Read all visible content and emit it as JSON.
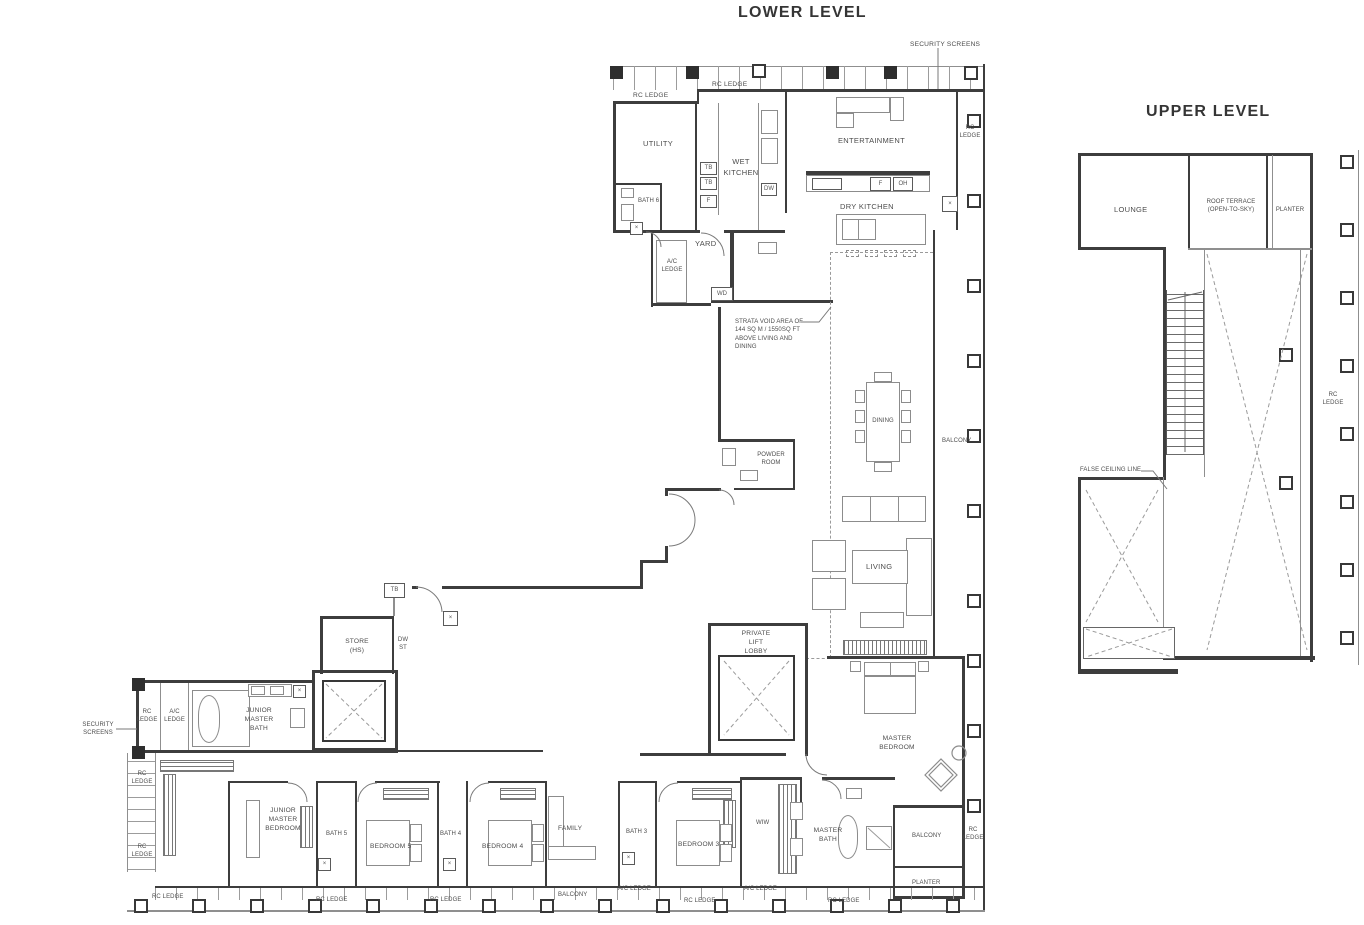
{
  "lower": {
    "title": "LOWER LEVEL",
    "labels": {
      "security_screens": "SECURITY SCREENS",
      "rc_ledge": "RC LEDGE",
      "ac_ledge": "A/C LEDGE",
      "utility": "UTILITY",
      "wet_kitchen": "WET KITCHEN",
      "bath_6": "BATH 6",
      "entertainment": "ENTERTAINMENT",
      "dry_kitchen": "DRY KITCHEN",
      "yard": "YARD",
      "tb": "TB",
      "f": "F",
      "oh": "OH",
      "dw": "DW",
      "wd": "WD",
      "dw_st": "DW\nST",
      "x_mark": "×",
      "strata_void": "STRATA VOID AREA OF\n144 SQ M / 1550SQ FT\nABOVE LIVING AND\nDINING",
      "dining": "DINING",
      "balcony": "BALCONY",
      "powder_room": "POWDER\nROOM",
      "living": "LIVING",
      "private_lift_lobby": "PRIVATE\nLIFT\nLOBBY",
      "store": "STORE\n(HS)",
      "junior_master_bath": "JUNIOR\nMASTER\nBATH",
      "junior_master_bedroom": "JUNIOR\nMASTER\nBEDROOM",
      "bath_5": "BATH 5",
      "bedroom_5": "BEDROOM 5",
      "bath_4": "BATH 4",
      "bedroom_4": "BEDROOM 4",
      "family": "FAMILY",
      "bath_3": "BATH 3",
      "bedroom_3": "BEDROOM 3",
      "wiw": "WIW",
      "master_bath": "MASTER\nBATH",
      "master_bedroom": "MASTER\nBEDROOM",
      "planter": "PLANTER"
    }
  },
  "upper": {
    "title": "UPPER LEVEL",
    "labels": {
      "lounge": "LOUNGE",
      "roof_terrace": "ROOF TERRACE\n(OPEN-TO-SKY)",
      "planter": "PLANTER",
      "false_ceiling_line": "FALSE CEILING LINE",
      "rc_ledge": "RC LEDGE"
    }
  },
  "colors": {
    "line": "#3d3d3d",
    "label": "#4c4c4c",
    "background": "#ffffff"
  }
}
